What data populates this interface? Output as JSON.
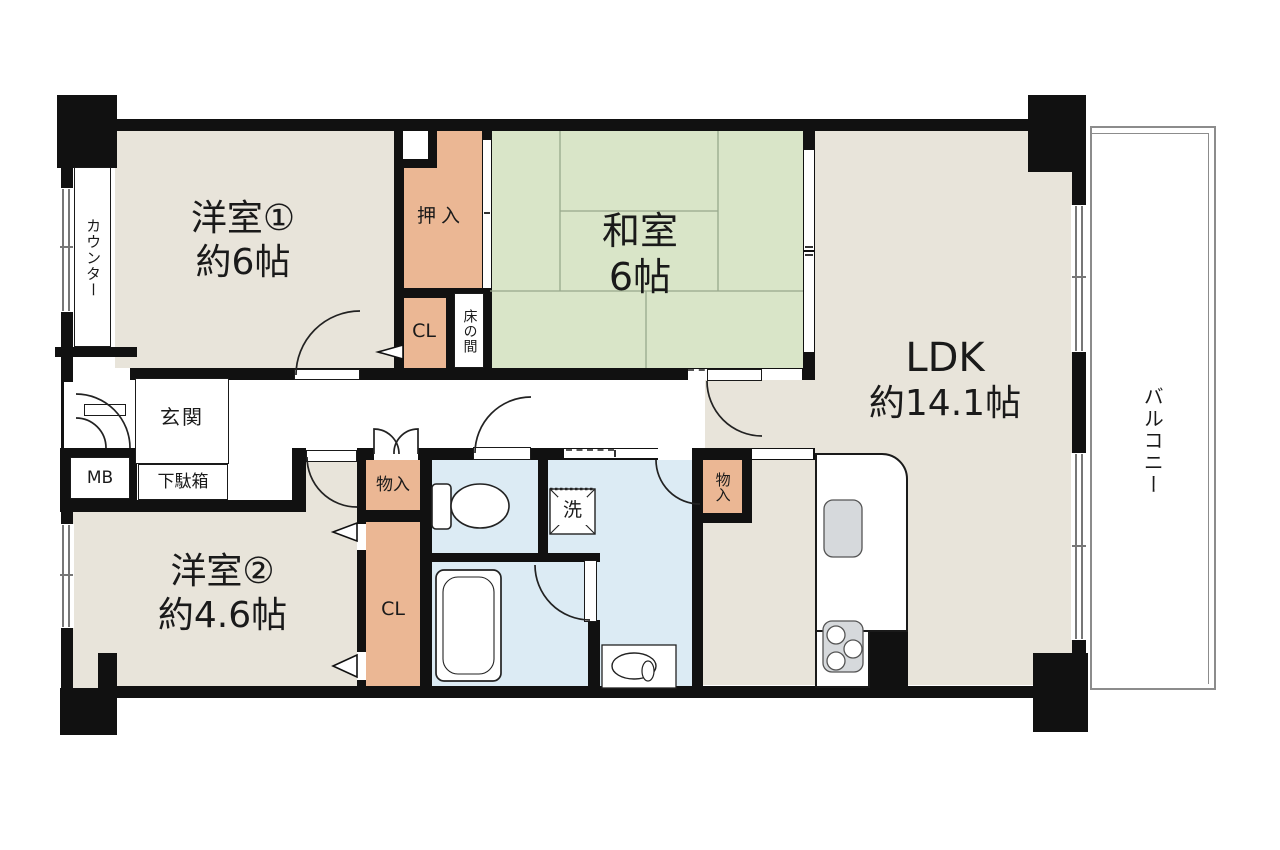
{
  "rooms": {
    "yoshitsu1": {
      "name": "洋室①",
      "size": "約6帖"
    },
    "washitsu": {
      "name": "和室",
      "size": "6帖"
    },
    "ldk": {
      "name": "LDK",
      "size": "約14.1帖"
    },
    "yoshitsu2": {
      "name": "洋室②",
      "size": "約4.6帖"
    },
    "genkan": "玄関",
    "balcony": "バルコニー"
  },
  "storage": {
    "oshiire": "押入",
    "cl_upper": "CL",
    "cl_lower": "CL",
    "tokonoma": "床の間",
    "monoire_hall": "物入",
    "monoire_kitchen": "物入",
    "getabako": "下駄箱",
    "counter": "カウンター",
    "mb": "MB"
  },
  "fixtures": {
    "washing_machine": "洗"
  },
  "colors": {
    "room_floor": "#e8e4da",
    "tatami": "#d9e5c8",
    "closet": "#ebb794",
    "wet_area": "#dcebf4",
    "wall": "#111111",
    "kitchen_fixture": "#d6d9dc",
    "balcony_line": "#8c8c8c"
  }
}
